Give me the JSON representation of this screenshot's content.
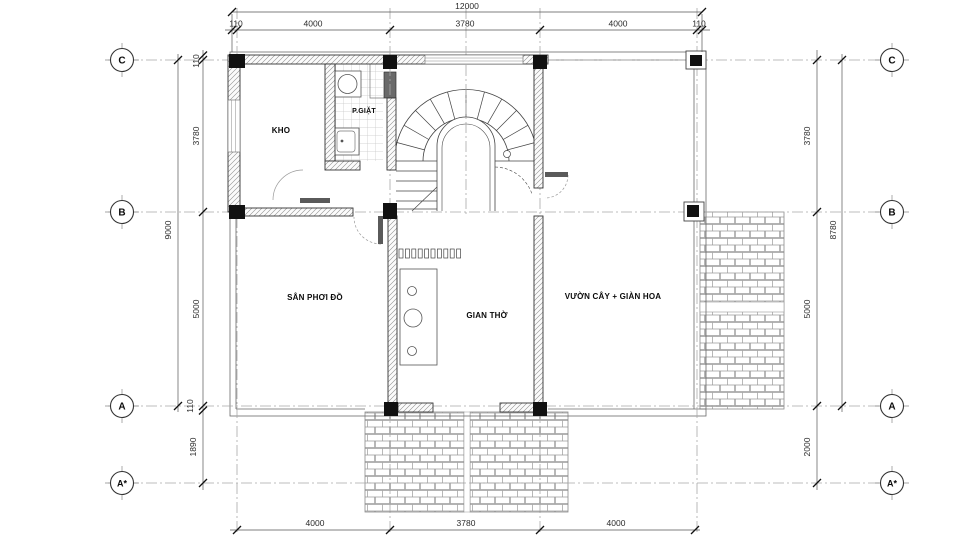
{
  "rooms": {
    "kho": "KHO",
    "p_giat": "P.GIẶT",
    "san_phoi_do": "SÂN PHƠI ĐỒ",
    "gian_tho": "GIAN THỜ",
    "vuon_cay": "VƯỜN CÂY + GIÀN HOA"
  },
  "grid": {
    "rows": [
      {
        "label": "C"
      },
      {
        "label": "B"
      },
      {
        "label": "A"
      },
      {
        "label": "A*"
      }
    ]
  },
  "dims": {
    "top_overall": "12000",
    "top": [
      "110",
      "4000",
      "3780",
      "4000",
      "110"
    ],
    "bottom": [
      "4000",
      "3780",
      "4000"
    ],
    "left_overall": "9000",
    "left": [
      "110",
      "3780",
      "5000",
      "110",
      "1890"
    ],
    "right_overall": "8780",
    "right": [
      "3780",
      "5000",
      "2000"
    ]
  },
  "colors": {
    "line": "#333333",
    "hatch": "#8f8f8f",
    "grid_line": "#a0a0a0",
    "column": "#111111",
    "text": "#111111"
  }
}
